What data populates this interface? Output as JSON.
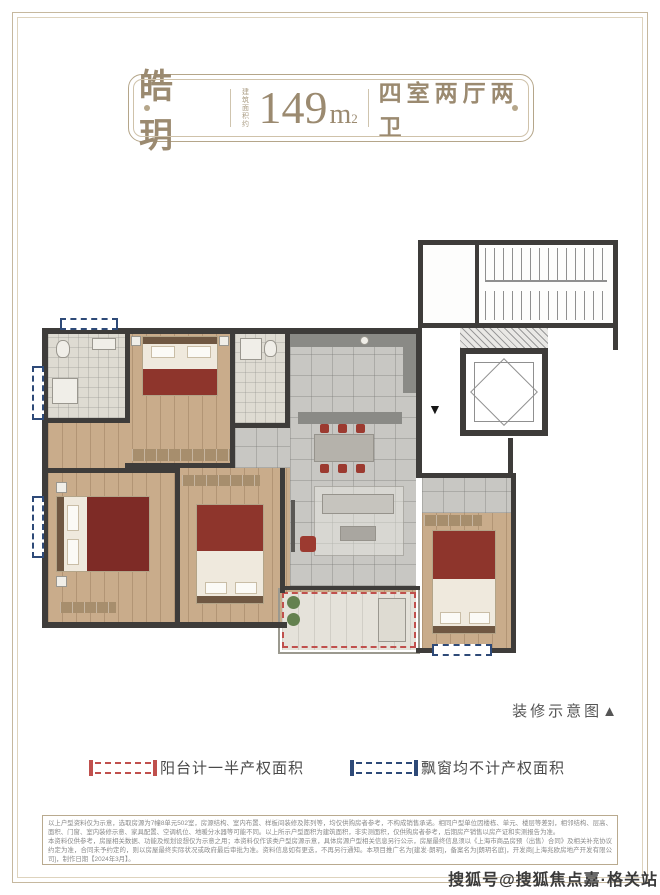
{
  "palette": {
    "frame": "#c6b89e",
    "plaque_text": "#9b8a70",
    "wall": "#3e3c3a",
    "wood_floor": "#c9ac8b",
    "tile_floor": "#c8c7c3",
    "accent_red": "#8e352c",
    "legend_red": "#c0504d",
    "legend_blue": "#2e4a78"
  },
  "header": {
    "name": "皓玥",
    "area_label": "建筑面积约",
    "area_value": "149",
    "area_unit": "m",
    "area_exponent": "2",
    "layout": "四室两厅两卫"
  },
  "plan": {
    "caption": "装修示意图▲",
    "entry_marker": "▼"
  },
  "legend": {
    "items": [
      {
        "label": "阳台计一半产权面积",
        "color": "#c0504d"
      },
      {
        "label": "飘窗均不计产权面积",
        "color": "#2e4a78"
      }
    ]
  },
  "disclaimer": {
    "para1": "以上户型资料仅为示意，选取房源为7幢8单元502室，房源结构、室内布置、样板间装修及陈列等，均仅供购房者参考，不构成销售承诺。相同户型单位因楼栋、单元、楼层等差别，相邻结构、层高、面积、门窗、室内装修示意、家具配置、空调机位、地暖分水器等可能不同。以上所示户型面积为建筑面积，非实测面积，仅供购房者参考，后期房产销售以房产证和实测报告为准。",
    "para2": "本资料仅供参考，房屋相关数据、功能及规划设想仅为示意之用；本资料仅作该类户型房源示意，具体房源户型相关信息另行公示，房屋最终信息须以《上海市商品房预（出售）合同》及相关补充协议约定为准，合同未予约定的，则以房屋最终实际状况或政府最后审批为准。资料信息如有更迭，不再另行通知。本项目推广名为[建发·朗玥]，备案名为[朗玥名庭]，开发商[上海兆欧房地产开发有限公司]，制作日期【2024年3月】。"
  },
  "watermark": {
    "text": "搜狐号@搜狐焦点嘉·格关站"
  }
}
